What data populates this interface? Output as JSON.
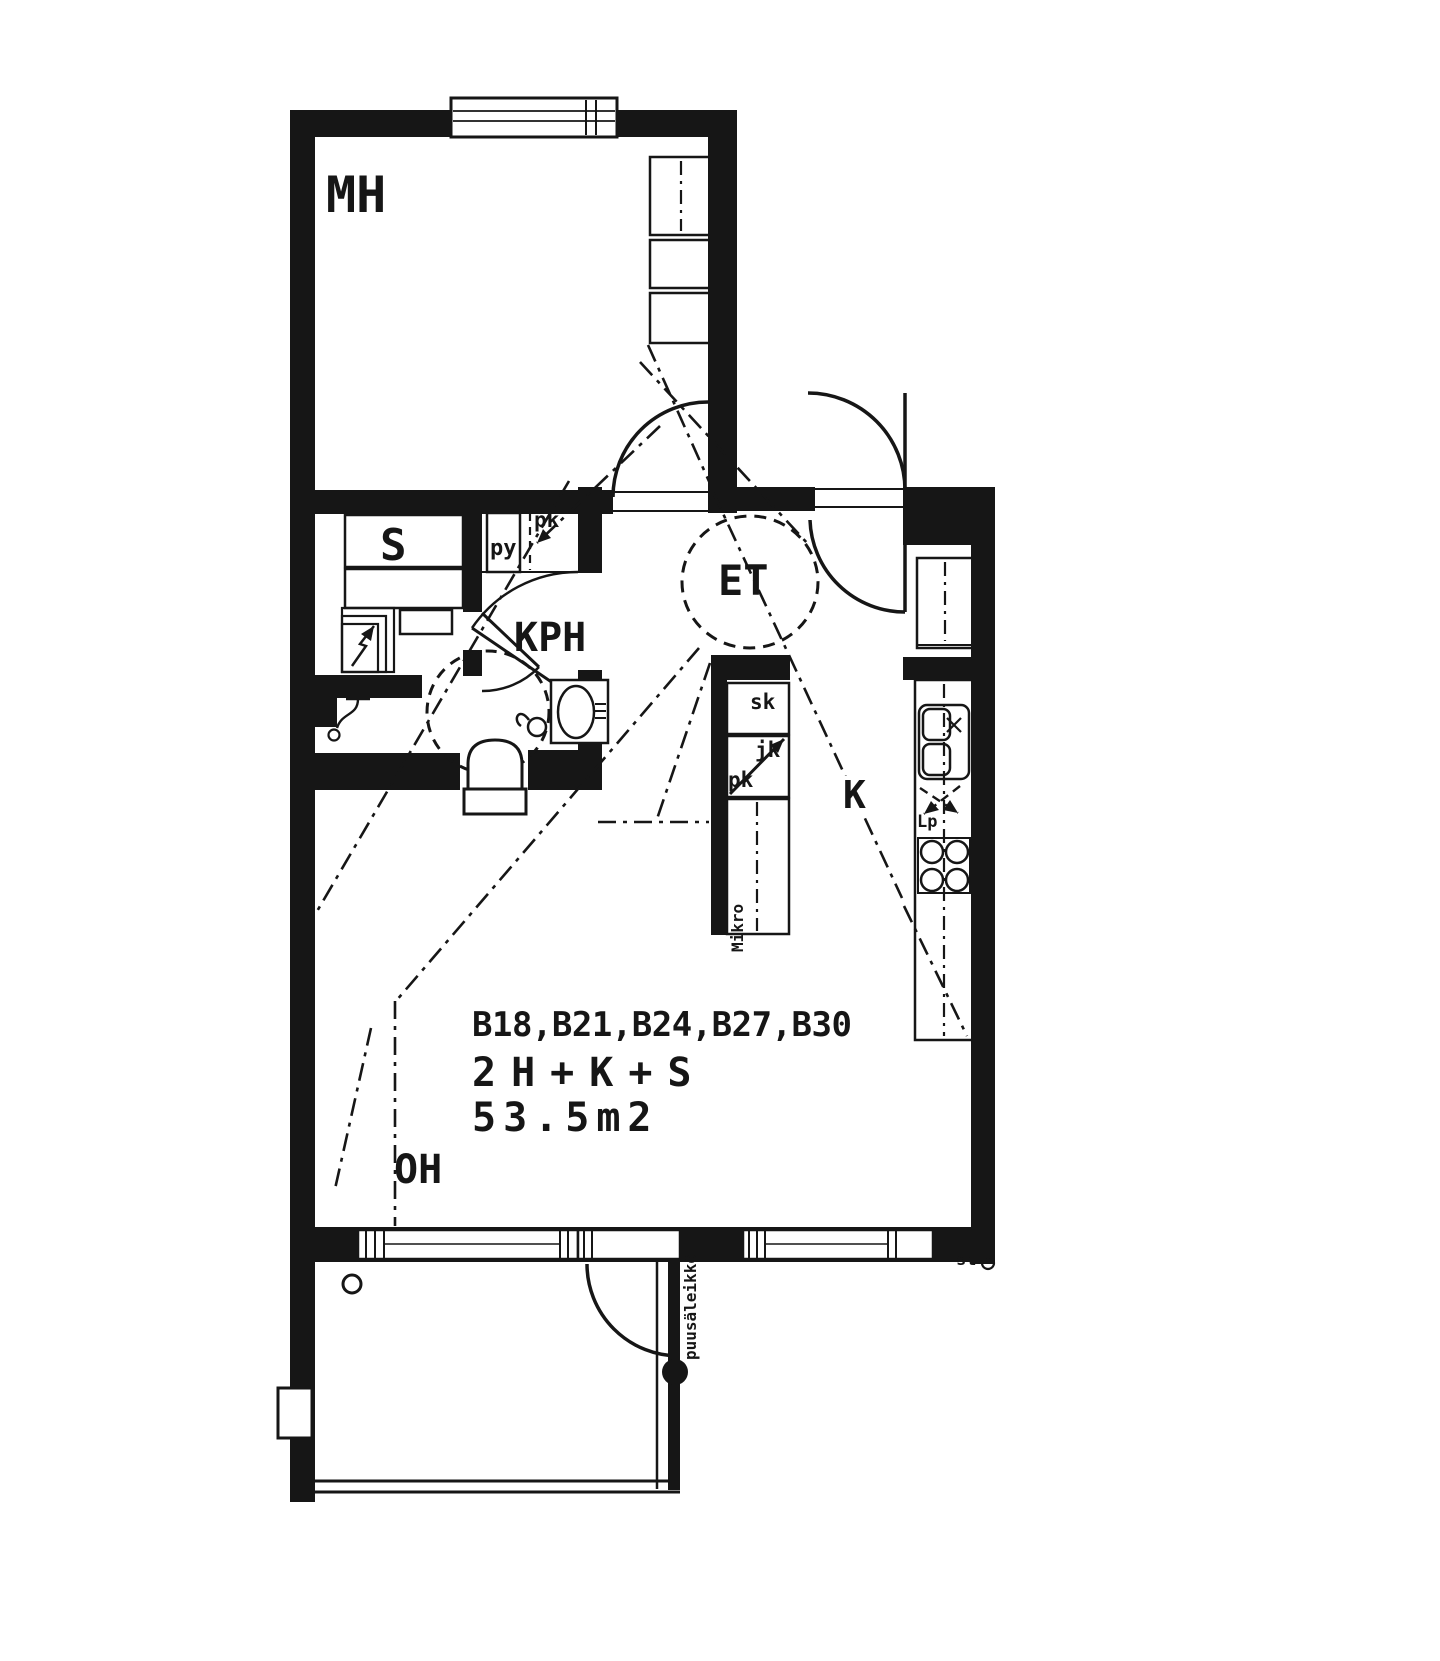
{
  "floor_plan": {
    "rooms": {
      "bedroom": {
        "label": "MH"
      },
      "sauna": {
        "label": "S"
      },
      "bathroom": {
        "label": "KPH"
      },
      "entrance_hall": {
        "label": "ET"
      },
      "kitchen": {
        "label": "K"
      },
      "living_room": {
        "label": "OH"
      }
    },
    "appliances": {
      "washing_machine": "py",
      "laundry_reservation": "pk",
      "cleaning_cupboard": "sk",
      "fridge": "jk",
      "freezer": "pk",
      "microwave_shelf": "Mikro",
      "dishwasher_reservation": "Lp",
      "riser_marker": "st"
    },
    "apartment_info": {
      "apartment_numbers": "B18,B21,B24,B27,B30",
      "room_configuration": "2H+K+S",
      "area": "53.5m2"
    },
    "balcony": {
      "wood_lattice": "puusäleikkö"
    },
    "colors": {
      "ink": "#161616",
      "paper": "#ffffff"
    }
  }
}
